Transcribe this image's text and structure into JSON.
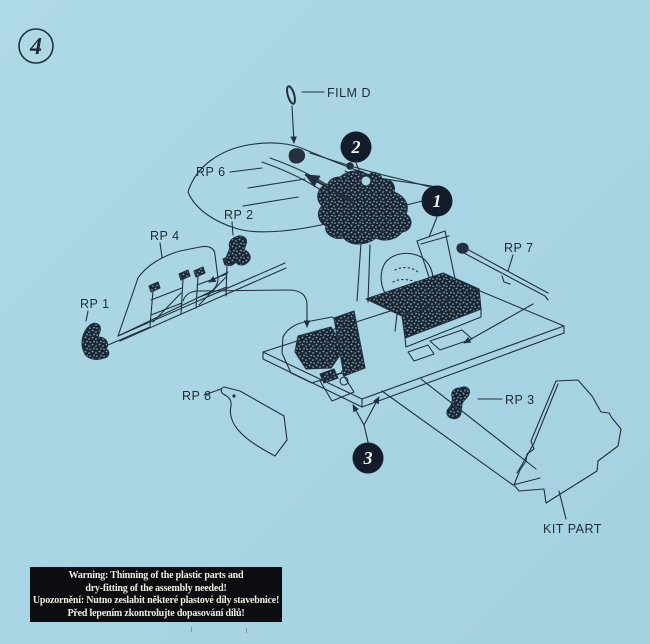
{
  "sheet": {
    "step_number": "4",
    "background_color": "#a9d5e3",
    "ink_color": "#22303e",
    "badge_color": "#131c2a",
    "warning_bg_color": "#0c0d11",
    "warning_text_color": "#efece1"
  },
  "part_labels": {
    "film": "FILM D",
    "rp1": "RP 1",
    "rp2": "RP 2",
    "rp3": "RP 3",
    "rp4": "RP 4",
    "rp6": "RP 6",
    "rp7": "RP 7",
    "rp8": "RP 8",
    "kit_part": "KIT PART"
  },
  "step_badges": {
    "seat": "1",
    "instrument_panel": "2",
    "floor": "3"
  },
  "warning_box": {
    "en_line1": "Warning: Thinning of the plastic parts and",
    "en_line2": "dry-fitting of the assembly needed!",
    "cz_line1": "Upozornění: Nutno zeslabit některé plastové díly stavebnice!",
    "cz_line2": "Před lepením zkontrolujte dopasování dílů!"
  }
}
